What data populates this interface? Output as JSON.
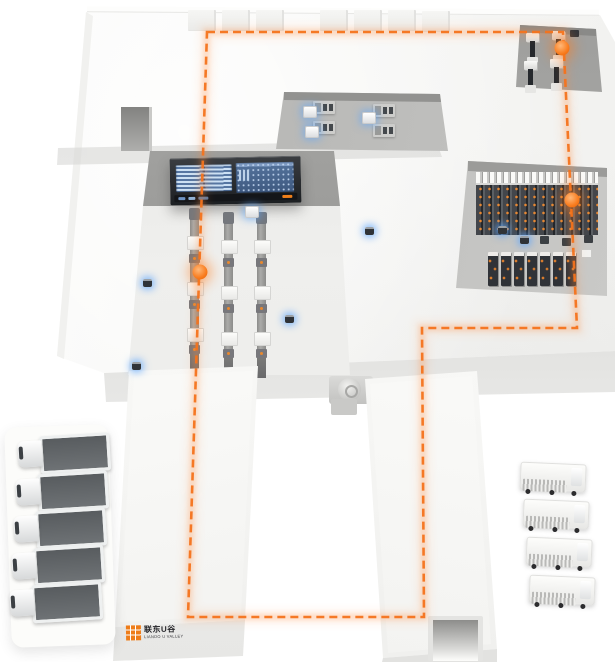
{
  "brand": {
    "logo_icon": "orange-grid-square-icon",
    "name_cn": "联东U谷",
    "name_en": "LIANDO U VALLEY"
  },
  "colors": {
    "route_orange": "#f4731c",
    "marker_orange": "#f97c1e",
    "logo_orange": "#ee7d1a",
    "agv_blue_glow": "#5aa5ff",
    "dashboard_frame": "#26282c",
    "dashboard_screen_left": "#5b7ca6",
    "dashboard_screen_right": "#54739c",
    "platform_white": "#f6f6f4",
    "recess_gray": "#b6b6b4",
    "rack_dark": "#303338"
  },
  "route": {
    "style": "dashed-loop",
    "points": "207,32 563,32 577,328 422,328 424,617 188,617",
    "markers": [
      {
        "x": 562,
        "y": 48
      },
      {
        "x": 572,
        "y": 200
      },
      {
        "x": 200,
        "y": 272
      }
    ]
  },
  "dashboard": {
    "screen_count": 2
  },
  "skylights": [
    {
      "x": 188,
      "y": 10,
      "w": 26,
      "h": 20
    },
    {
      "x": 222,
      "y": 10,
      "w": 26,
      "h": 20
    },
    {
      "x": 256,
      "y": 10,
      "w": 26,
      "h": 20
    },
    {
      "x": 320,
      "y": 10,
      "w": 26,
      "h": 20
    },
    {
      "x": 354,
      "y": 10,
      "w": 26,
      "h": 20
    },
    {
      "x": 388,
      "y": 10,
      "w": 26,
      "h": 20
    },
    {
      "x": 422,
      "y": 11,
      "w": 26,
      "h": 20
    }
  ],
  "conveyors": {
    "lines": [
      {
        "x": 186,
        "y": 214
      },
      {
        "x": 220,
        "y": 218
      },
      {
        "x": 253,
        "y": 218
      }
    ]
  },
  "workstations": {
    "desks": [
      {
        "x": 313,
        "y": 101
      },
      {
        "x": 313,
        "y": 121
      },
      {
        "x": 373,
        "y": 104
      },
      {
        "x": 373,
        "y": 124
      }
    ]
  },
  "machines": {
    "units": [
      {
        "x": 526,
        "y": 33
      },
      {
        "x": 552,
        "y": 31
      },
      {
        "x": 524,
        "y": 61
      },
      {
        "x": 550,
        "y": 59
      }
    ]
  },
  "racks": {
    "mid_units": [
      {
        "x": 540,
        "y": 236
      },
      {
        "x": 562,
        "y": 238
      },
      {
        "x": 584,
        "y": 235
      }
    ],
    "front": [
      {
        "x": 488,
        "y": 252
      },
      {
        "x": 501,
        "y": 252
      },
      {
        "x": 514,
        "y": 252
      },
      {
        "x": 527,
        "y": 252
      },
      {
        "x": 540,
        "y": 252
      },
      {
        "x": 553,
        "y": 252
      },
      {
        "x": 566,
        "y": 252
      }
    ]
  },
  "agvs": {
    "small": [
      {
        "x": 143,
        "y": 279
      },
      {
        "x": 285,
        "y": 315
      },
      {
        "x": 132,
        "y": 362
      },
      {
        "x": 365,
        "y": 227
      },
      {
        "x": 498,
        "y": 226
      },
      {
        "x": 520,
        "y": 236
      }
    ],
    "white": [
      {
        "x": 303,
        "y": 106
      },
      {
        "x": 305,
        "y": 126
      },
      {
        "x": 362,
        "y": 112
      },
      {
        "x": 245,
        "y": 206
      }
    ]
  },
  "trucks": {
    "left": [
      {
        "x": 16,
        "y": 434
      },
      {
        "x": 14,
        "y": 472
      },
      {
        "x": 12,
        "y": 509
      },
      {
        "x": 10,
        "y": 546
      },
      {
        "x": 8,
        "y": 583
      }
    ],
    "right": [
      {
        "x": 520,
        "y": 463
      },
      {
        "x": 523,
        "y": 500
      },
      {
        "x": 526,
        "y": 538
      },
      {
        "x": 529,
        "y": 576
      }
    ]
  }
}
